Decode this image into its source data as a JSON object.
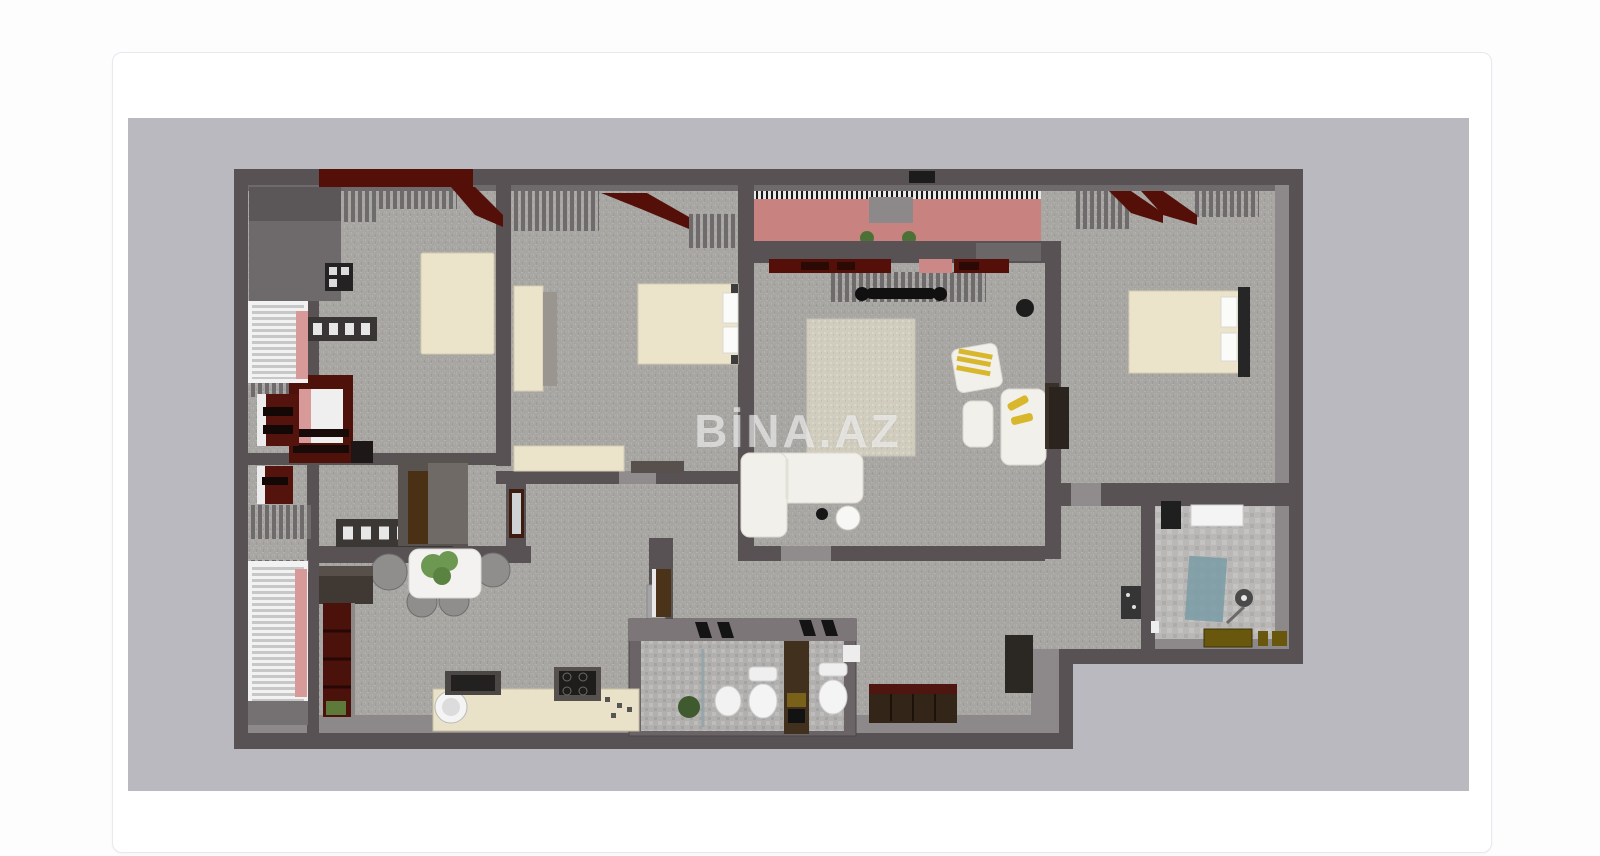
{
  "page": {
    "background": "#fdfdfd"
  },
  "card": {
    "background": "#ffffff",
    "border_color": "#e8e8ee",
    "radius_px": 10
  },
  "floorplan": {
    "background": "#b9b9bf",
    "watermark": {
      "text": "BİNA.AZ",
      "color": "rgba(255,255,255,0.55)"
    },
    "palette": {
      "wall": "#585254",
      "wall_inner_face": "#8d898b",
      "carpet": "#a7a6a3",
      "furniture_cream": "#ebe3ca",
      "accent_maroon": "#541008",
      "balcony_pink": "#c8827f",
      "accent_yellow": "#d8b72c",
      "shower_teal": "#7d9da6",
      "rug_beige": "#d0ccbe"
    },
    "rooms": [
      {
        "name": "bedroom-top-left",
        "furniture": [
          "bed",
          "wardrobe",
          "dresser"
        ]
      },
      {
        "name": "bedroom-top-middle",
        "furniture": [
          "bed",
          "wardrobe",
          "dresser"
        ]
      },
      {
        "name": "living-room",
        "furniture": [
          "sofa",
          "armchair",
          "ottoman",
          "rug",
          "tv"
        ]
      },
      {
        "name": "bedroom-right",
        "furniture": [
          "bed"
        ]
      },
      {
        "name": "balcony-top",
        "furniture": [
          "plants"
        ]
      },
      {
        "name": "balcony-left",
        "furniture": [
          "window-blinds",
          "radiators"
        ]
      },
      {
        "name": "kitchen",
        "furniture": [
          "counter",
          "sink",
          "stove",
          "dining-table",
          "chairs",
          "bookshelf"
        ]
      },
      {
        "name": "wc",
        "furniture": [
          "toilet",
          "toilet",
          "sink",
          "plant"
        ]
      },
      {
        "name": "bathroom",
        "furniture": [
          "shower",
          "sink",
          "cabinet"
        ]
      },
      {
        "name": "hallway",
        "furniture": [
          "console",
          "wardrobe",
          "dresser"
        ]
      }
    ]
  }
}
